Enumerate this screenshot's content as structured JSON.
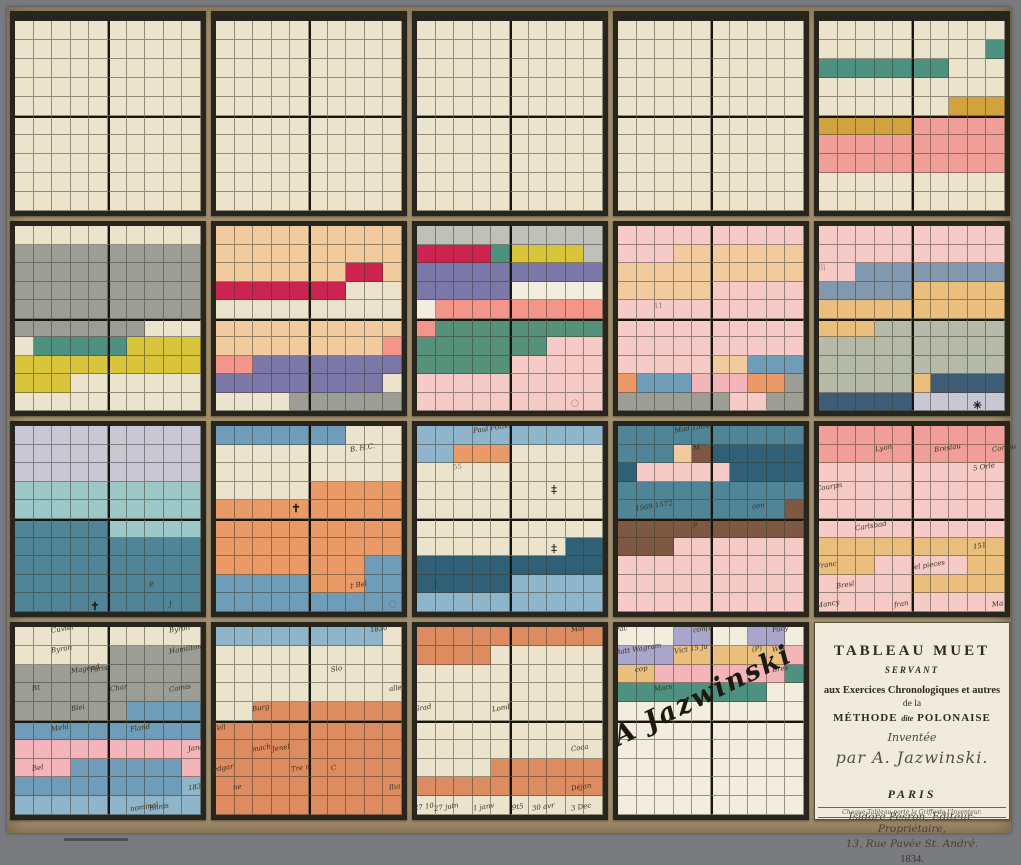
{
  "artifact": {
    "kind": "hand-coloured mnemonic chart, Méthode Polonaise, 5x4 panels of 10x10 squares"
  },
  "palette": {
    ".": "#ebe3cb",
    "w": "#f2edde",
    "G": "#9c9e96",
    "Y": "#d9c53c",
    "T": "#4f9180",
    "O": "#d2a23f",
    "P": "#f19e98",
    "p": "#f6cac6",
    "b": "#f1ca9e",
    "C": "#cd2351",
    "V": "#7b77a9",
    "S": "#f4958a",
    "L": "#bfc0ba",
    "g": "#55917b",
    "E": "#8298ae",
    "u": "#eabf7e",
    "A": "#b6baa9",
    "d": "#3f5c76",
    "l": "#c9c7d3",
    "t": "#9dc7c6",
    "M": "#4f8596",
    "B": "#6f9db9",
    "o": "#e99a67",
    "a": "#8eb5ca",
    "D": "#2f6076",
    "R": "#7d5943",
    "r": "#f3b5ba",
    "F": "#dd8b60",
    "v": "#a9a5cb"
  },
  "panels": [
    {
      "id": "r1c1",
      "rows": [
        "..........",
        "..........",
        "..........",
        "..........",
        "..........",
        "..........",
        "..........",
        "..........",
        "..........",
        ".........."
      ],
      "annotations": []
    },
    {
      "id": "r1c2",
      "rows": [
        "..........",
        "..........",
        "..........",
        "..........",
        "..........",
        "..........",
        "..........",
        "..........",
        "..........",
        ".........."
      ],
      "annotations": []
    },
    {
      "id": "r1c3",
      "rows": [
        "..........",
        "..........",
        "..........",
        "..........",
        "..........",
        "..........",
        "..........",
        "..........",
        "..........",
        ".........."
      ],
      "annotations": []
    },
    {
      "id": "r1c4",
      "rows": [
        "..........",
        "..........",
        "..........",
        "..........",
        "..........",
        "..........",
        "..........",
        "..........",
        "..........",
        ".........."
      ],
      "annotations": []
    },
    {
      "id": "r1c5",
      "rows": [
        "..........",
        ".........T",
        "TTTTTTT...",
        "..........",
        ".......OOO",
        "OOOOOPPPPP",
        "PPPPPPPPPP",
        "PPPPPPPPPP",
        "..........",
        ".........."
      ],
      "annotations": []
    },
    {
      "id": "r2c1",
      "rows": [
        "..........",
        "GGGGGGGGGG",
        "GGGGGGGGGG",
        "GGGGGGGGGG",
        "GGGGGGGGGG",
        "GGGGGGG...",
        ".TTTTTYYYY",
        "YYYYYYYYYY",
        "YYY.......",
        ".........."
      ],
      "annotations": []
    },
    {
      "id": "r2c2",
      "rows": [
        "bbbbbbbbbb",
        "bbbbbbbbbb",
        "bbbbbbbCCb",
        "CCCCCCC...",
        "..........",
        "bbbbbbbbbb",
        "bbbbbbbbbS",
        "SSVVVVVVVV",
        "VVVVVVVVV.",
        "....GGGGGG"
      ],
      "annotations": []
    },
    {
      "id": "r2c3",
      "rows": [
        "LLLLLLLLLL",
        "CCCCTYYYYL",
        "VVVVVVVVVV",
        "VVVVVwwwww",
        "wSSSSSSSSS",
        "Sggggggggg",
        "gggggggppp",
        "gggggppppp",
        "pppppppppp",
        "pppppppppp"
      ],
      "annotations": [
        {
          "r": 9,
          "c": 8,
          "text": "◯",
          "kind": "pencil"
        }
      ]
    },
    {
      "id": "r2c4",
      "rows": [
        "pppppppppp",
        "pppbbbbbbb",
        "bbbbbbbbbb",
        "bbbbbppppp",
        "pppppppppp",
        "pppppppppp",
        "pppppppppp",
        "pppppbbBBB",
        "oBBBrrrooG",
        "GGGGGGppGG"
      ],
      "annotations": [
        {
          "r": 4,
          "c": 2,
          "text": "11",
          "kind": "pencil"
        }
      ]
    },
    {
      "id": "r2c5",
      "rows": [
        "pppppppppp",
        "pppppppppp",
        "ppEEEEEEEE",
        "EEEEEuuuuu",
        "uuuuuuuuuu",
        "uuuAAAAAAA",
        "AAAAAAAAAA",
        "AAAAAAAAAA",
        "AAAAAudddd",
        "dddddlllll"
      ],
      "annotations": [
        {
          "r": 2,
          "c": 0,
          "text": "||||",
          "kind": "pencil"
        },
        {
          "r": 9,
          "c": 8,
          "text": "✳",
          "kind": "symbol"
        }
      ]
    },
    {
      "id": "r3c1",
      "rows": [
        "llllllllll",
        "llllllllll",
        "llllllllll",
        "tttttttttt",
        "tttttttttt",
        "MMMMMttttt",
        "MMMMMMMMMM",
        "MMMMMMMMMM",
        "MMMMMMMMMM",
        "MMMMMMMMMM"
      ],
      "annotations": [
        {
          "r": 8,
          "c": 7,
          "text": "P.",
          "kind": "ink"
        },
        {
          "r": 9,
          "c": 4,
          "text": "✝",
          "kind": "symbol"
        },
        {
          "r": 9,
          "c": 8,
          "text": "J",
          "kind": "ink"
        }
      ]
    },
    {
      "id": "r3c2",
      "rows": [
        "BBBBBBB...",
        "..........",
        "..........",
        ".....ooooo",
        "oooooooooo",
        "oooooooooo",
        "oooooooooo",
        "ooooooooBB",
        "BBBBBoooBB",
        "BBBBBBBBBB"
      ],
      "annotations": [
        {
          "r": 1,
          "c": 7,
          "text": "B. H.C.",
          "kind": "ink"
        },
        {
          "r": 4,
          "c": 4,
          "text": "✝",
          "kind": "symbol"
        },
        {
          "r": 8,
          "c": 7,
          "text": "‡ Bel",
          "kind": "ink"
        },
        {
          "r": 9,
          "c": 9,
          "text": "◯",
          "kind": "pencil"
        }
      ]
    },
    {
      "id": "r3c3",
      "rows": [
        "aaaaaaaaaa",
        "aaooo.....",
        "..........",
        "..........",
        "..........",
        "..........",
        "........DD",
        "DDDDDDDDDD",
        "DDDDDaaaaa",
        "aaaaaaaaaa"
      ],
      "annotations": [
        {
          "r": 0,
          "c": 3,
          "text": "Paul Potter",
          "kind": "ink"
        },
        {
          "r": 2,
          "c": 2,
          "text": "55",
          "kind": "pencil"
        },
        {
          "r": 3,
          "c": 7,
          "text": "‡",
          "kind": "symbol"
        },
        {
          "r": 6,
          "c": 7,
          "text": "‡",
          "kind": "symbol"
        },
        {
          "r": 8,
          "c": 1,
          "text": "J.",
          "kind": "ink"
        }
      ]
    },
    {
      "id": "r3c4",
      "rows": [
        "MMMMMMMMMM",
        "MMMbRDDDDD",
        "DpppppDDDD",
        "MMMMMMMMMM",
        "MMMMMMMMMR",
        "RRRRRRRRRR",
        "RRRppppppp",
        "pppppppppp",
        "pppppppppp",
        "pppppppppp"
      ],
      "annotations": [
        {
          "r": 0,
          "c": 3,
          "text": "Mad 1504",
          "kind": "ink"
        },
        {
          "r": 1,
          "c": 4,
          "text": "M",
          "kind": "ink"
        },
        {
          "r": 4,
          "c": 1,
          "text": "1569 1572",
          "kind": "ink"
        },
        {
          "r": 4,
          "c": 7,
          "text": "con",
          "kind": "ink"
        },
        {
          "r": 5,
          "c": 4,
          "text": "P",
          "kind": "ink"
        }
      ]
    },
    {
      "id": "r3c5",
      "rows": [
        "PPPPPPPPPP",
        "PPPPPPPPPP",
        "pppppppppp",
        "pppppppppp",
        "pppppppppp",
        "pppppppppp",
        "uuuuuuuuuu",
        "uuupppppuu",
        "pppppuuuuu",
        "pppppppppp"
      ],
      "annotations": [
        {
          "r": 1,
          "c": 3,
          "text": "Lyon",
          "kind": "ink"
        },
        {
          "r": 1,
          "c": 6,
          "text": "Breslau",
          "kind": "ink"
        },
        {
          "r": 1,
          "c": 9,
          "text": "Corfou",
          "kind": "ink"
        },
        {
          "r": 2,
          "c": 8,
          "text": "5 Orle",
          "kind": "ink"
        },
        {
          "r": 3,
          "c": 0,
          "text": "Courpn",
          "kind": "ink"
        },
        {
          "r": 5,
          "c": 2,
          "text": "Carlsbad",
          "kind": "ink"
        },
        {
          "r": 6,
          "c": 8,
          "text": "151",
          "kind": "ink"
        },
        {
          "r": 7,
          "c": 0,
          "text": "Franc",
          "kind": "ink"
        },
        {
          "r": 7,
          "c": 5,
          "text": "el pieces",
          "kind": "ink"
        },
        {
          "r": 8,
          "c": 1,
          "text": "Bresl",
          "kind": "ink"
        },
        {
          "r": 9,
          "c": 0,
          "text": "Mancy",
          "kind": "ink"
        },
        {
          "r": 9,
          "c": 4,
          "text": "fran",
          "kind": "ink"
        },
        {
          "r": 9,
          "c": 9,
          "text": "Ma",
          "kind": "ink"
        }
      ]
    },
    {
      "id": "r4c1",
      "rows": [
        "..........",
        ".....GGGGG",
        "GGGGGGGGGG",
        "GGGGGGGGGG",
        "GGGGGGBBBB",
        "BBBBBBBBBB",
        "rrrrrrrrrr",
        "rrrBBBBBBr",
        "BBBBBBBBBa",
        "aaaaaaaaaa"
      ],
      "annotations": [
        {
          "r": 0,
          "c": 2,
          "text": "Cuvier",
          "kind": "ink"
        },
        {
          "r": 0,
          "c": 8,
          "text": "Byron",
          "kind": "ink"
        },
        {
          "r": 1,
          "c": 2,
          "text": "Byron",
          "kind": "ink"
        },
        {
          "r": 1,
          "c": 8,
          "text": "Hamilton",
          "kind": "ink"
        },
        {
          "r": 2,
          "c": 3,
          "text": "Magend",
          "kind": "ink"
        },
        {
          "r": 2,
          "c": 4,
          "text": "Paris",
          "kind": "ink"
        },
        {
          "r": 3,
          "c": 1,
          "text": "Rt",
          "kind": "ink"
        },
        {
          "r": 3,
          "c": 5,
          "text": "Char",
          "kind": "ink"
        },
        {
          "r": 3,
          "c": 8,
          "text": "Camis",
          "kind": "ink"
        },
        {
          "r": 4,
          "c": 3,
          "text": "Blei",
          "kind": "ink"
        },
        {
          "r": 5,
          "c": 2,
          "text": "Mehl",
          "kind": "ink"
        },
        {
          "r": 5,
          "c": 6,
          "text": "Fland",
          "kind": "ink"
        },
        {
          "r": 6,
          "c": 9,
          "text": "Jana",
          "kind": "ink"
        },
        {
          "r": 7,
          "c": 1,
          "text": "Bel",
          "kind": "ink"
        },
        {
          "r": 8,
          "c": 9,
          "text": "1830",
          "kind": "ink"
        },
        {
          "r": 9,
          "c": 6,
          "text": "nominal",
          "kind": "ink"
        },
        {
          "r": 9,
          "c": 7,
          "text": "Blinis",
          "kind": "ink"
        }
      ]
    },
    {
      "id": "r4c2",
      "rows": [
        "aaaaaaaaa.",
        "..........",
        "..........",
        "..........",
        "..FFFFFFFF",
        "FFFFFFFFFF",
        "FFFFFFFFFF",
        "FFFFFFFFFF",
        "FFFFFFFFFF",
        "FFFFFFFFFF"
      ],
      "annotations": [
        {
          "r": 0,
          "c": 8,
          "text": "1830",
          "kind": "ink"
        },
        {
          "r": 2,
          "c": 6,
          "text": "Slo",
          "kind": "ink"
        },
        {
          "r": 3,
          "c": 9,
          "text": "alles",
          "kind": "ink"
        },
        {
          "r": 4,
          "c": 2,
          "text": "Burg",
          "kind": "ink"
        },
        {
          "r": 5,
          "c": 0,
          "text": "Tell",
          "kind": "ink"
        },
        {
          "r": 6,
          "c": 2,
          "text": "mach",
          "kind": "ink"
        },
        {
          "r": 6,
          "c": 3,
          "text": "Jenel",
          "kind": "ink"
        },
        {
          "r": 7,
          "c": 0,
          "text": "edgar",
          "kind": "ink"
        },
        {
          "r": 7,
          "c": 4,
          "text": "Tre m",
          "kind": "ink"
        },
        {
          "r": 7,
          "c": 6,
          "text": "C",
          "kind": "ink"
        },
        {
          "r": 8,
          "c": 1,
          "text": "ne",
          "kind": "ink"
        },
        {
          "r": 8,
          "c": 9,
          "text": "Ilia",
          "kind": "ink"
        }
      ]
    },
    {
      "id": "r4c3",
      "rows": [
        "FFFFFFFFFF",
        "FFFF......",
        "..........",
        "..........",
        "..........",
        "..........",
        "..........",
        "....FFFFFF",
        "FFFFFFFFFF",
        ".........."
      ],
      "annotations": [
        {
          "r": 0,
          "c": 8,
          "text": "Mal",
          "kind": "ink"
        },
        {
          "r": 4,
          "c": 0,
          "text": "Grad",
          "kind": "ink"
        },
        {
          "r": 4,
          "c": 4,
          "text": "Lomb",
          "kind": "ink"
        },
        {
          "r": 6,
          "c": 8,
          "text": "Coca",
          "kind": "ink"
        },
        {
          "r": 8,
          "c": 8,
          "text": "Déjan",
          "kind": "ink"
        },
        {
          "r": 9,
          "c": 0,
          "text": "27 10",
          "kind": "ink"
        },
        {
          "r": 9,
          "c": 1,
          "text": "27 juin",
          "kind": "ink"
        },
        {
          "r": 9,
          "c": 3,
          "text": "1 janv",
          "kind": "ink"
        },
        {
          "r": 9,
          "c": 5,
          "text": "9t5",
          "kind": "ink"
        },
        {
          "r": 9,
          "c": 6,
          "text": "30 avr",
          "kind": "ink"
        },
        {
          "r": 9,
          "c": 8,
          "text": "3 Dec",
          "kind": "ink"
        }
      ]
    },
    {
      "id": "r4c4",
      "rows": [
        "wwwvvwwvvw",
        "vvvuuuuuur",
        "uurrrrrrrT",
        "TTTTTTTTww",
        "wwwwwwwwww",
        "wwwwwwwwww",
        "wwwwwwwwww",
        "wwwwwwwwww",
        "wwwwwwwwww",
        "wwwwwwwwww"
      ],
      "annotations": [
        {
          "r": 0,
          "c": 0,
          "text": "Pac",
          "kind": "ink"
        },
        {
          "r": 0,
          "c": 4,
          "text": "confu",
          "kind": "ink"
        },
        {
          "r": 0,
          "c": 8,
          "text": "Pacy",
          "kind": "ink"
        },
        {
          "r": 1,
          "c": 0,
          "text": "Batt Wagram",
          "kind": "ink"
        },
        {
          "r": 1,
          "c": 3,
          "text": "Vict 15 ju",
          "kind": "ink"
        },
        {
          "r": 1,
          "c": 7,
          "text": "(P)",
          "kind": "ink"
        },
        {
          "r": 1,
          "c": 8,
          "text": "WG",
          "kind": "ink"
        },
        {
          "r": 2,
          "c": 1,
          "text": "cop",
          "kind": "ink"
        },
        {
          "r": 2,
          "c": 8,
          "text": "Bres",
          "kind": "ink"
        },
        {
          "r": 3,
          "c": 2,
          "text": "Mars",
          "kind": "ink"
        },
        {
          "r": 5,
          "c": 0,
          "text": "A Jazwinski",
          "kind": "signature"
        }
      ]
    }
  ],
  "title_panel": {
    "line1": "TABLEAU MUET",
    "line2": "SERVANT",
    "line3": "aux Exercices Chronologiques et autres",
    "line4": "de la",
    "line5a": "MÉTHODE",
    "line5b": "dite",
    "line5c": "POLONAISE",
    "line6": "Inventée",
    "line7": "par A. Jazwinski.",
    "line8": "PARIS",
    "line9": "Isidore Pesron, Éditeur-Propriétaire,",
    "line10": "13, Rue Pavée St. André.",
    "line11": "1834.",
    "footer": "Chaque Tableau porte la Griffe de l'Inventeur."
  }
}
